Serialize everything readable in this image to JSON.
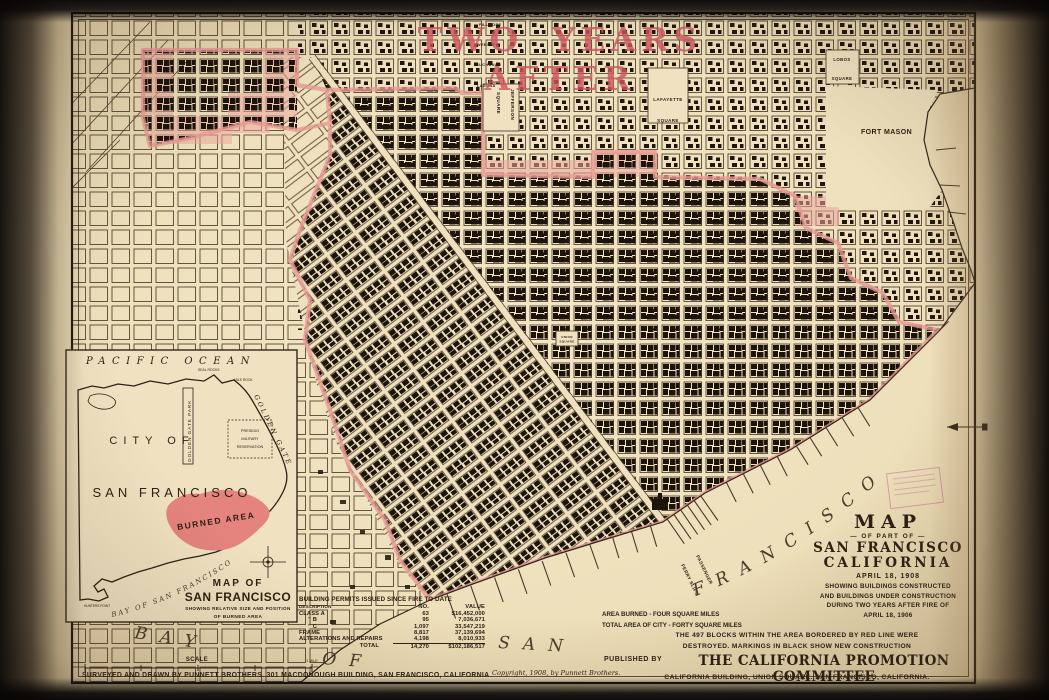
{
  "title": {
    "text": "TWO YEARS AFTER"
  },
  "colors": {
    "paper": "#efe1bd",
    "ink": "#2e2114",
    "accent_red": "#cd575e",
    "burn_pink": "#e89a94",
    "building_black": "#1c130b",
    "stamp_magenta": "#b74690"
  },
  "legend_table": {
    "header": "BUILDING PERMITS ISSUED SINCE FIRE TO DATE",
    "columns": [
      "DESCRIPTION",
      "NO.",
      "VALUE"
    ],
    "rows": [
      {
        "desc": "CLASS A",
        "no": "63",
        "value": "$16,452,000"
      },
      {
        "desc": "”  B",
        "no": "95",
        "value": "7,036,671"
      },
      {
        "desc": "”  C",
        "no": "1,097",
        "value": "33,547,219"
      },
      {
        "desc": "FRAME",
        "no": "8,817",
        "value": "37,139,694"
      },
      {
        "desc": "ALTERATIONS AND REPAIRS",
        "no": "4,198",
        "value": "8,010,933"
      }
    ],
    "total": {
      "desc": "TOTAL",
      "no": "14,270",
      "value": "$102,186,517"
    }
  },
  "stats": {
    "line1": "AREA BURNED - FOUR SQUARE MILES",
    "line2": "TOTAL AREA OF CITY - FORTY SQUARE MILES"
  },
  "title_block": {
    "l1": "MAP",
    "l2": "— OF PART OF —",
    "l3": "SAN FRANCISCO",
    "l4": "CALIFORNIA",
    "l5": "APRIL 18, 1908",
    "l6": "SHOWING BUILDINGS CONSTRUCTED",
    "l7": "AND BUILDINGS UNDER CONSTRUCTION",
    "l8": "DURING TWO YEARS AFTER FIRE OF",
    "l9": "APRIL 18, 1906",
    "l10": "THE 497  BLOCKS WITHIN THE AREA BORDERED BY RED LINE WERE",
    "l11": "DESTROYED.   MARKINGS IN BLACK SHOW NEW CONSTRUCTION",
    "published_by": "PUBLISHED BY",
    "publisher": "THE CALIFORNIA PROMOTION COMMITTEE",
    "publisher_addr": "CALIFORNIA BUILDING, UNION SQUARE.  SAN FRANCISCO, CALIFORNIA."
  },
  "credits": {
    "surveyed": "SURVEYED AND DRAWN BY PUNNETT BROTHERS.  301 MACDONOUGH BUILDING, SAN FRANCISCO, CALIFORNIA",
    "copyright": "Copyright, 1908, by Punnett Brothers.",
    "scale_label": "SCALE",
    "scale_unit": "1 MILE"
  },
  "map_labels": {
    "lobos_1": "LOBOS",
    "lobos_2": "SQUARE",
    "lafayette_1": "LAFAYETTE",
    "lafayette_2": "SQUARE",
    "jefferson_1": "JEFFERSON",
    "jefferson_2": "SQUARE",
    "fort_mason": "FORT  MASON",
    "union_1": "UNION",
    "union_2": "SQUARE",
    "passenger": "PASSENGER",
    "ferry_slips": "FERRY SLIPS",
    "street_1": "FILLMORE",
    "street_2": "WEBSTER",
    "street_3": "BUCHANAN",
    "street_4": "LAGUNA"
  },
  "water": {
    "bay": "BAY",
    "of": "OF",
    "san": "SAN",
    "francisco": "FRANCISCO"
  },
  "inset": {
    "ocean": "PACIFIC  OCEAN",
    "seal_rocks": "SEAL ROCKS",
    "mile_rock": "MILE ROCK",
    "city_1": "CITY  OF",
    "city_2": "SAN  FRANCISCO",
    "golden_gate": "GOLDEN GATE",
    "gg_park": "GOLDEN GATE PARK",
    "presidio_1": "PRESIDIO",
    "presidio_2": "MILITARY",
    "presidio_3": "RESERVATION",
    "burned_area": "BURNED AREA",
    "hunters_point": "HUNTERS POINT",
    "bay_label": "BAY OF SAN FRANCISCO",
    "caption_1": "MAP OF",
    "caption_2": "SAN FRANCISCO",
    "caption_3": "SHOWING RELATIVE SIZE AND POSITION",
    "caption_4": "OF BURNED AREA"
  }
}
